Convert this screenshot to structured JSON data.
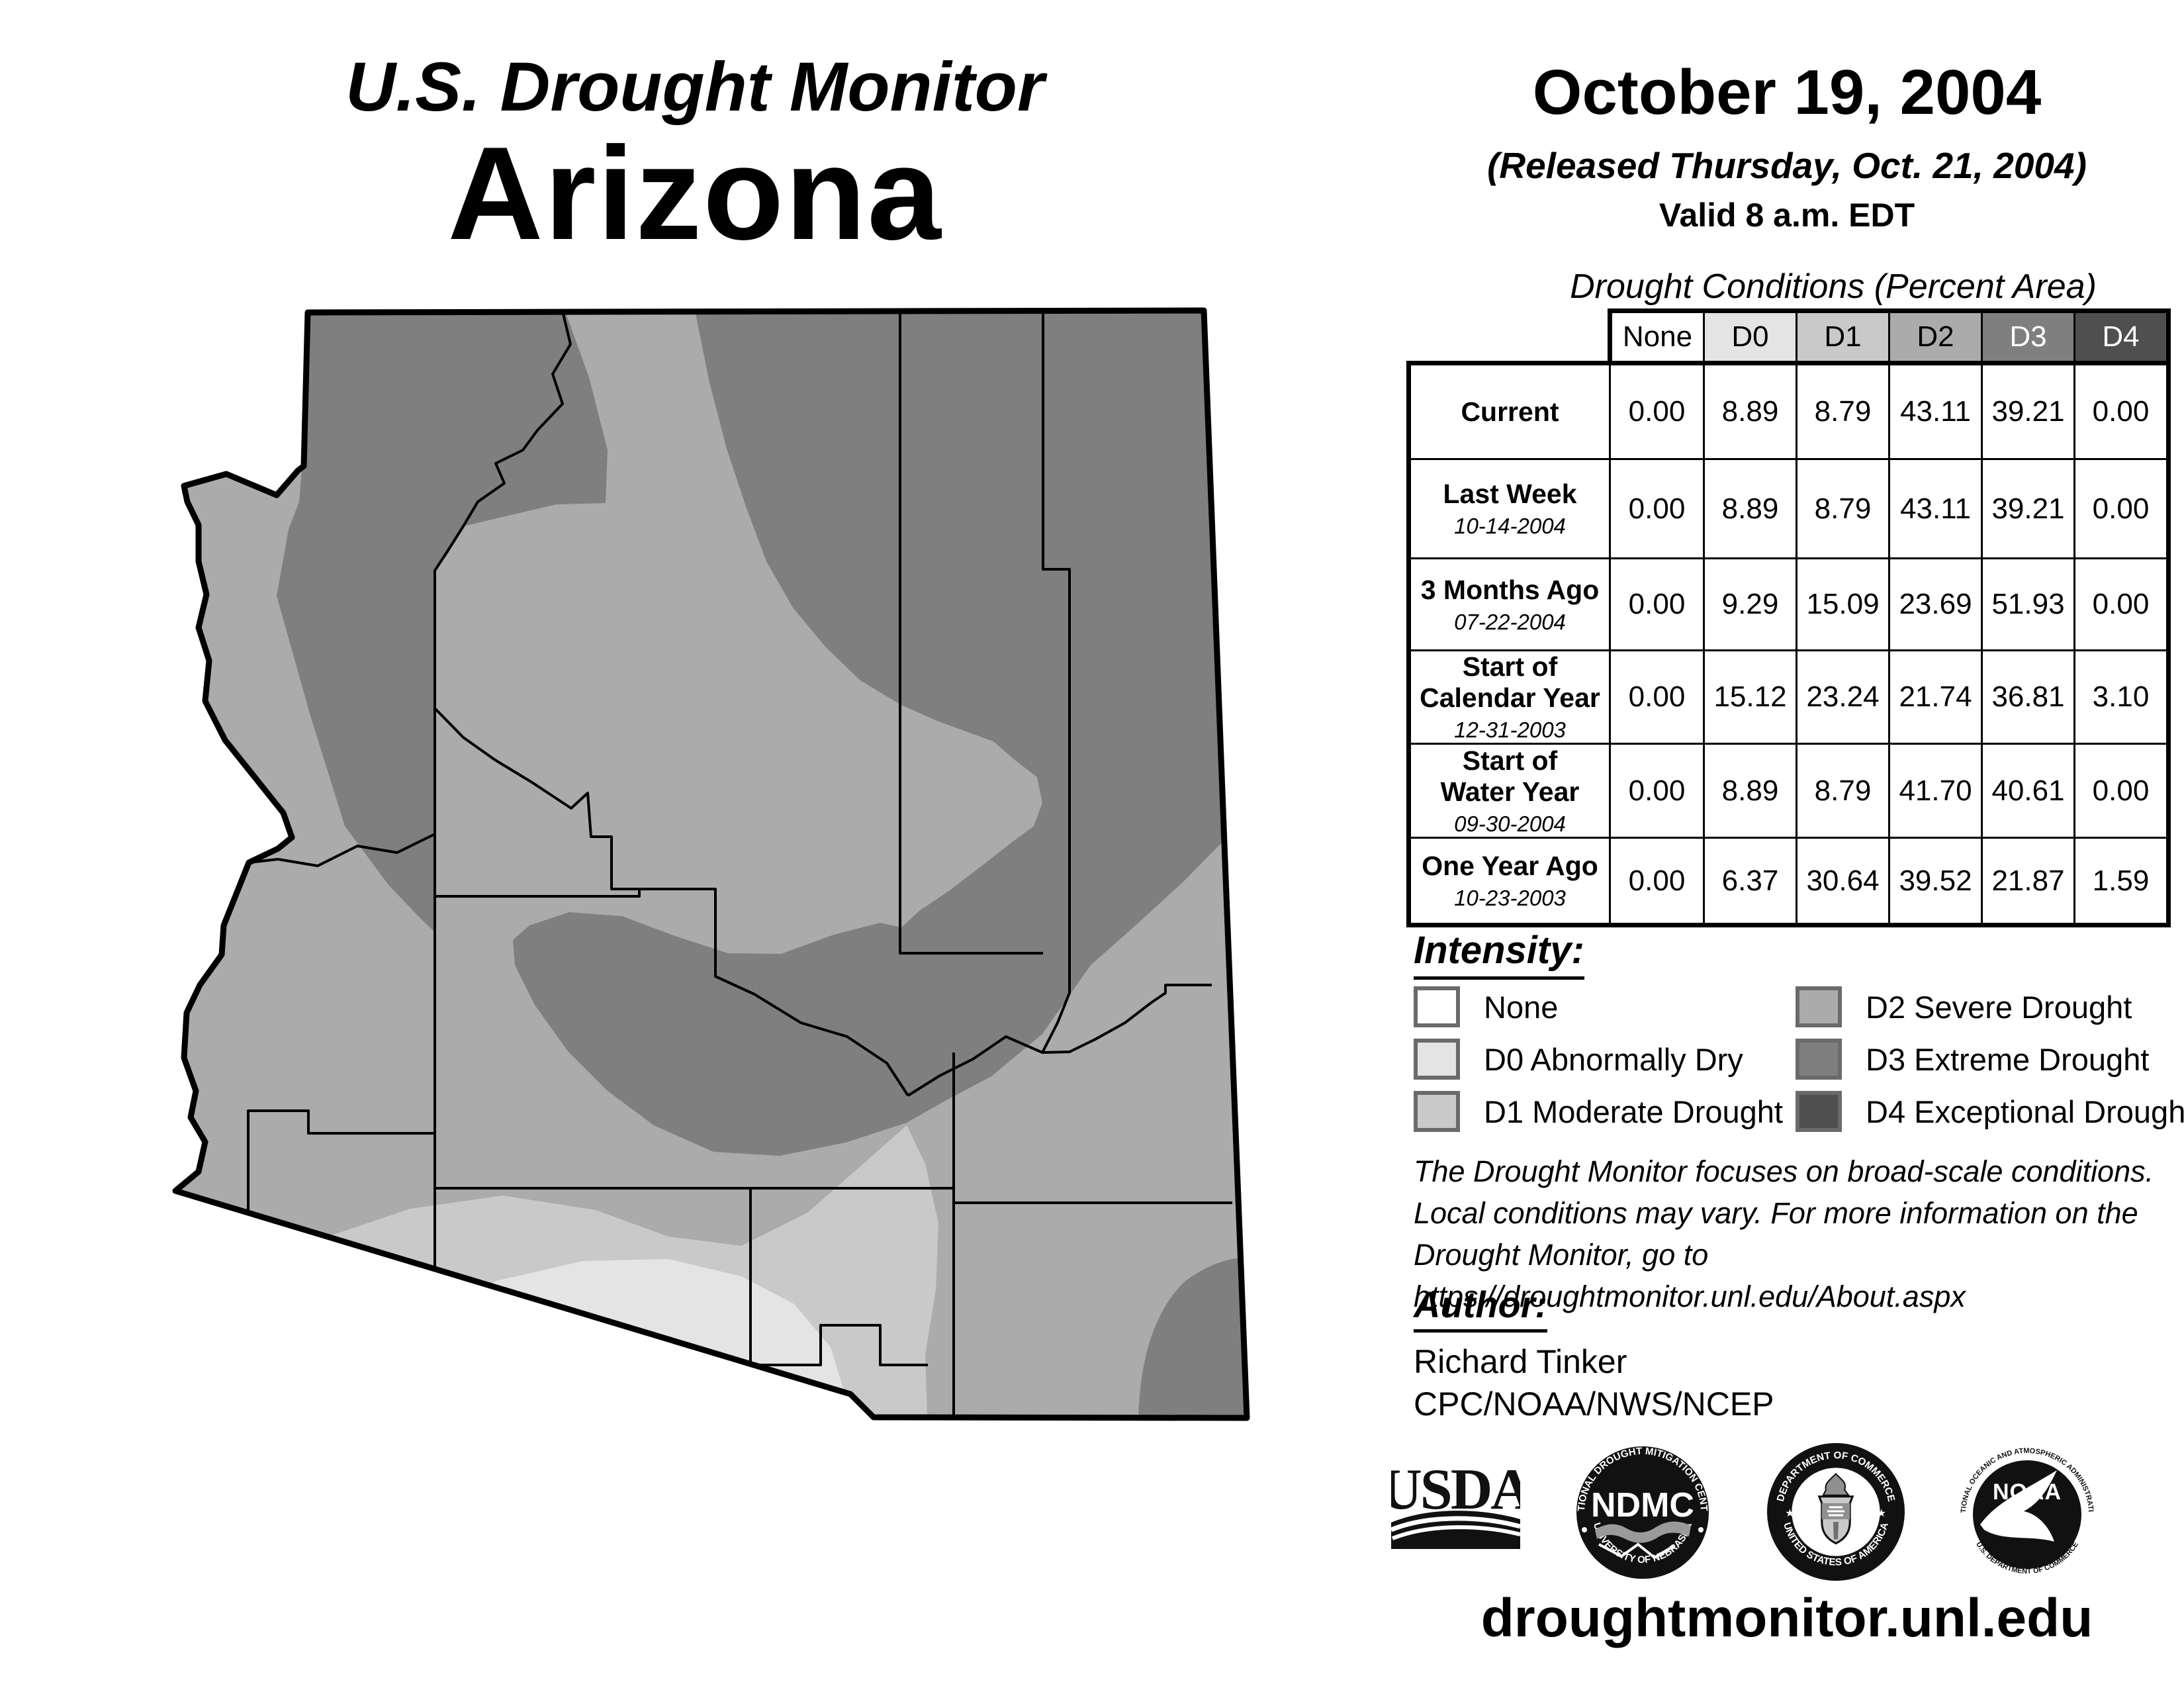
{
  "title": {
    "line1": "U.S. Drought Monitor",
    "line2": "Arizona"
  },
  "header": {
    "date": "October 19, 2004",
    "released": "(Released Thursday, Oct. 21, 2004)",
    "valid": "Valid 8 a.m. EDT"
  },
  "table": {
    "title": "Drought Conditions (Percent Area)",
    "columns": [
      "None",
      "D0",
      "D1",
      "D2",
      "D3",
      "D4"
    ],
    "rows": [
      {
        "label": "Current",
        "date": "",
        "values": [
          "0.00",
          "8.89",
          "8.79",
          "43.11",
          "39.21",
          "0.00"
        ]
      },
      {
        "label": "Last Week",
        "date": "10-14-2004",
        "values": [
          "0.00",
          "8.89",
          "8.79",
          "43.11",
          "39.21",
          "0.00"
        ]
      },
      {
        "label": "3 Months Ago",
        "date": "07-22-2004",
        "values": [
          "0.00",
          "9.29",
          "15.09",
          "23.69",
          "51.93",
          "0.00"
        ]
      },
      {
        "label": "Start of\nCalendar Year",
        "date": "12-31-2003",
        "values": [
          "0.00",
          "15.12",
          "23.24",
          "21.74",
          "36.81",
          "3.10"
        ]
      },
      {
        "label": "Start of\nWater Year",
        "date": "09-30-2004",
        "values": [
          "0.00",
          "8.89",
          "8.79",
          "41.70",
          "40.61",
          "0.00"
        ]
      },
      {
        "label": "One Year Ago",
        "date": "10-23-2003",
        "values": [
          "0.00",
          "6.37",
          "30.64",
          "39.52",
          "21.87",
          "1.59"
        ]
      }
    ]
  },
  "intensity": {
    "heading": "Intensity:",
    "items": [
      {
        "code": "none",
        "label": "None",
        "color": "#ffffff"
      },
      {
        "code": "d0",
        "label": "D0 Abnormally Dry",
        "color": "#e4e4e4"
      },
      {
        "code": "d1",
        "label": "D1 Moderate Drought",
        "color": "#c9c9c9"
      },
      {
        "code": "d2",
        "label": "D2 Severe Drought",
        "color": "#ababab"
      },
      {
        "code": "d3",
        "label": "D3 Extreme Drought",
        "color": "#7f7f7f"
      },
      {
        "code": "d4",
        "label": "D4 Exceptional Drought",
        "color": "#4f4f4f"
      }
    ]
  },
  "disclaimer_lines": [
    "The Drought Monitor focuses on broad-scale conditions.",
    "Local conditions may vary. For more information on the",
    "Drought Monitor, go to https://droughtmonitor.unl.edu/About.aspx"
  ],
  "author": {
    "heading": "Author:",
    "name": "Richard Tinker",
    "org": "CPC/NOAA/NWS/NCEP"
  },
  "footer": {
    "url": "droughtmonitor.unl.edu"
  },
  "logos": {
    "usda": "USDA",
    "ndmc": "NDMC",
    "ndmc_top": "NATIONAL DROUGHT MITIGATION CENTER",
    "ndmc_bottom": "UNIVERSITY OF NEBRASKA",
    "doc_top": "DEPARTMENT OF COMMERCE",
    "doc_bottom": "UNITED STATES OF AMERICA",
    "noaa": "NOAA",
    "noaa_top": "NATIONAL OCEANIC AND ATMOSPHERIC ADMINISTRATION",
    "noaa_bottom": "U.S. DEPARTMENT OF COMMERCE"
  },
  "map": {
    "region_fills": {
      "base_d2": "#ababab",
      "d3": "#7f7f7f",
      "d1": "#c9c9c9",
      "d0": "#e4e4e4",
      "outline": "#000000"
    }
  }
}
